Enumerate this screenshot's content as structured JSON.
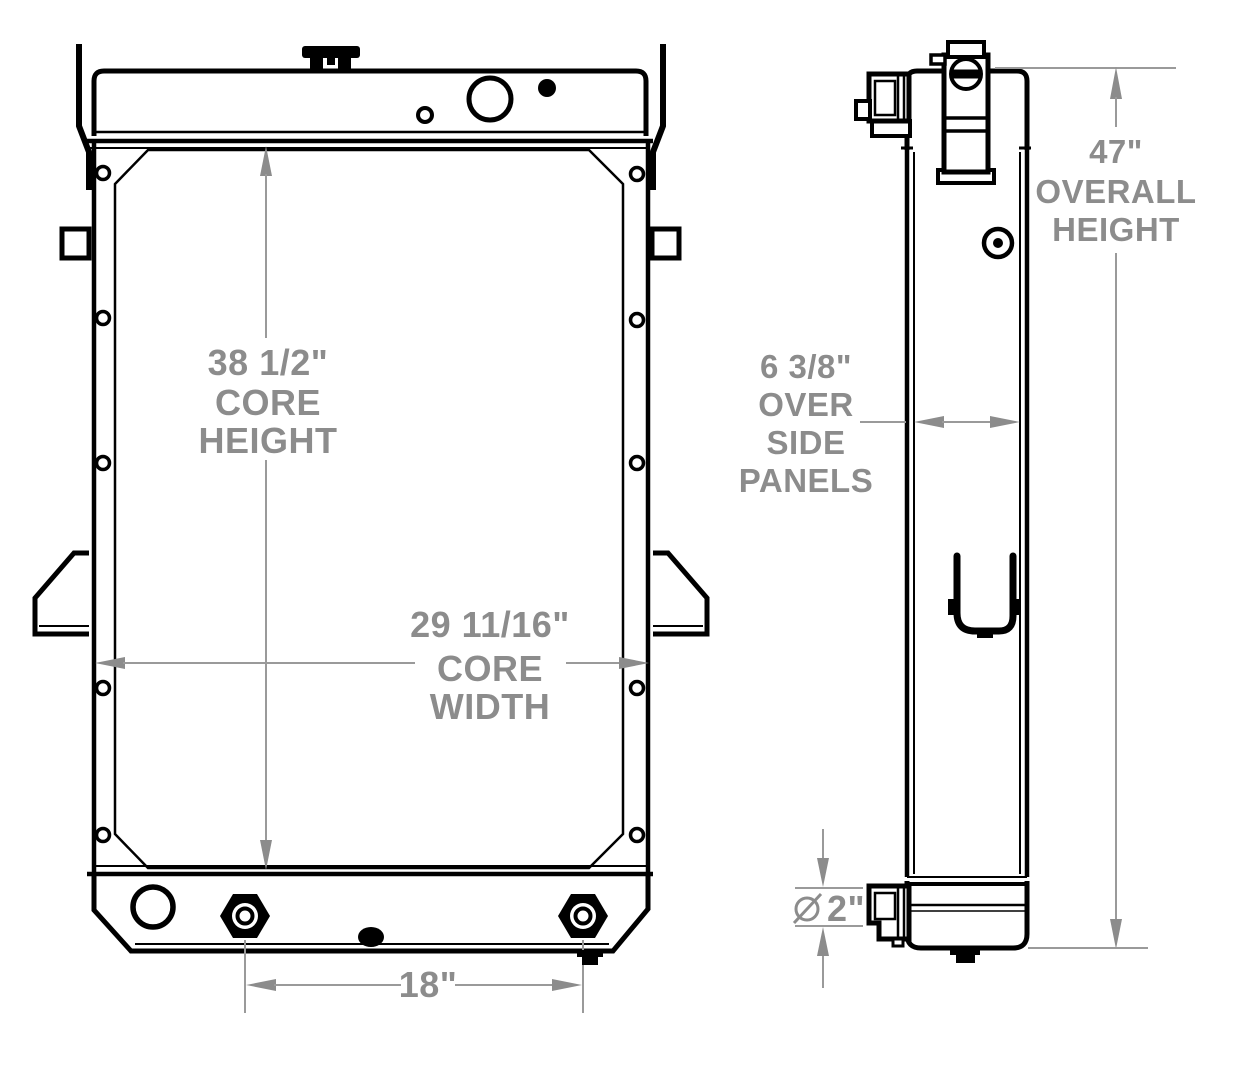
{
  "drawing": {
    "type": "technical-dimension-drawing",
    "subject": "radiator front and side views",
    "colors": {
      "outline": "#000000",
      "dimension_gray": "#8c8c8c",
      "background": "#ffffff"
    },
    "dimensions": {
      "core_height": {
        "value": "38 1/2\"",
        "label1": "CORE",
        "label2": "HEIGHT"
      },
      "core_width": {
        "value": "29 11/16\"",
        "label1": "CORE",
        "label2": "WIDTH"
      },
      "mount_spacing": {
        "value": "18\""
      },
      "overall_height": {
        "value": "47\"",
        "label1": "OVERALL",
        "label2": "HEIGHT"
      },
      "depth_over_panels": {
        "value": "6 3/8\"",
        "label1": "OVER",
        "label2": "SIDE",
        "label3": "PANELS"
      },
      "outlet_diameter": {
        "symbol": "⌀",
        "value": "2\""
      }
    }
  }
}
